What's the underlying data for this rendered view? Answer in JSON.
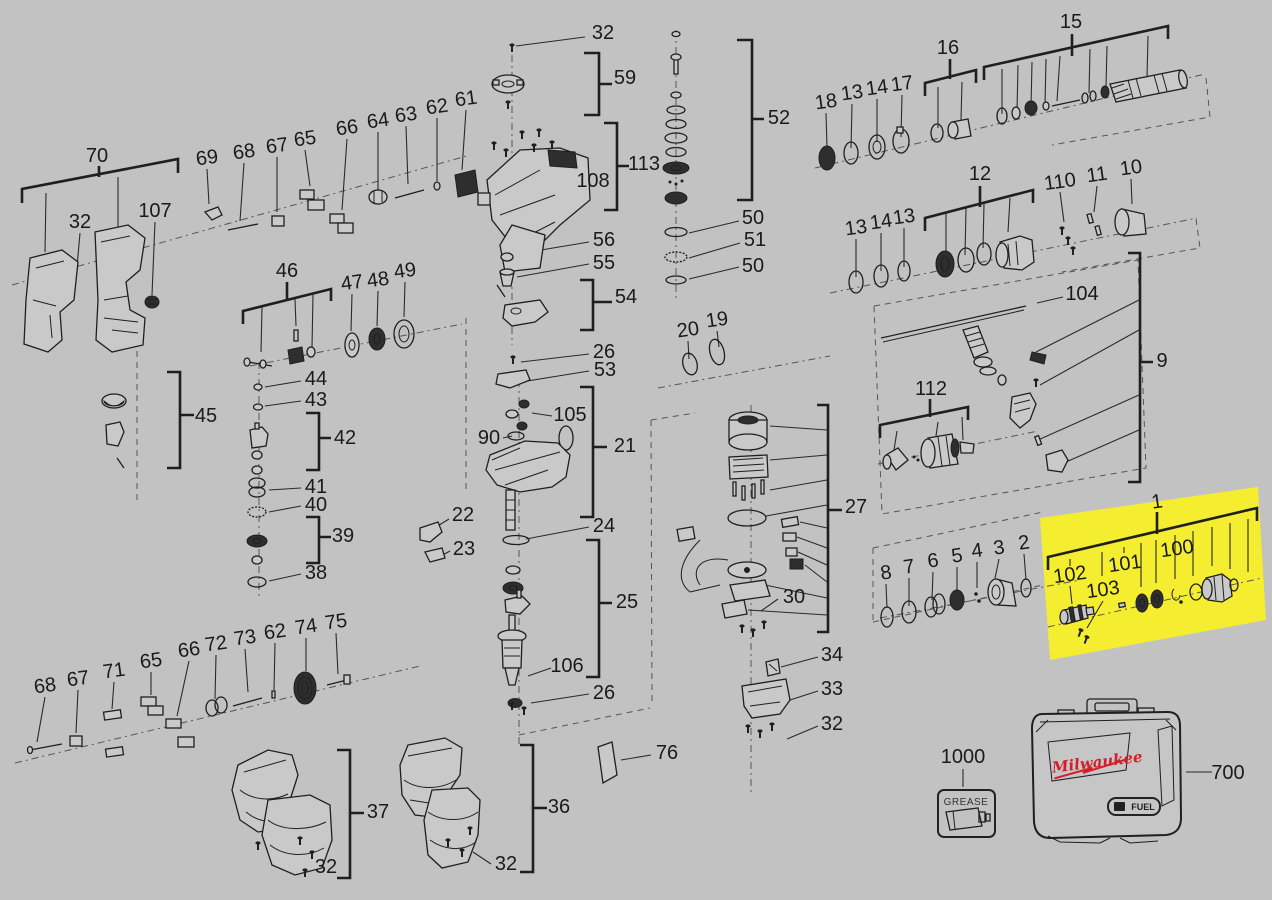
{
  "diagram": {
    "type": "exploded-parts-diagram",
    "background_color": "#c2c2c2",
    "line_color": "#1f1f1f",
    "highlight_color": "#f5ee30",
    "labels": [
      {
        "t": "70",
        "x": 97,
        "y": 156,
        "r": 0
      },
      {
        "t": "32",
        "x": 80,
        "y": 222,
        "r": 0
      },
      {
        "t": "107",
        "x": 155,
        "y": 211,
        "r": 0
      },
      {
        "t": "69",
        "x": 207,
        "y": 158,
        "r": -8
      },
      {
        "t": "68",
        "x": 244,
        "y": 152,
        "r": -8
      },
      {
        "t": "67",
        "x": 277,
        "y": 146,
        "r": -8
      },
      {
        "t": "65",
        "x": 305,
        "y": 139,
        "r": -8
      },
      {
        "t": "66",
        "x": 347,
        "y": 128,
        "r": -8
      },
      {
        "t": "64",
        "x": 378,
        "y": 121,
        "r": -8
      },
      {
        "t": "63",
        "x": 406,
        "y": 115,
        "r": -8
      },
      {
        "t": "62",
        "x": 437,
        "y": 107,
        "r": -8
      },
      {
        "t": "61",
        "x": 466,
        "y": 99,
        "r": -8
      },
      {
        "t": "32",
        "x": 603,
        "y": 33,
        "r": 0
      },
      {
        "t": "59",
        "x": 625,
        "y": 78,
        "r": 0
      },
      {
        "t": "113",
        "x": 644,
        "y": 164,
        "r": 0
      },
      {
        "t": "108",
        "x": 593,
        "y": 181,
        "r": 0
      },
      {
        "t": "56",
        "x": 604,
        "y": 240,
        "r": 0
      },
      {
        "t": "55",
        "x": 604,
        "y": 263,
        "r": 0
      },
      {
        "t": "54",
        "x": 626,
        "y": 297,
        "r": 0
      },
      {
        "t": "26",
        "x": 604,
        "y": 352,
        "r": 0
      },
      {
        "t": "53",
        "x": 605,
        "y": 370,
        "r": 0
      },
      {
        "t": "105",
        "x": 570,
        "y": 415,
        "r": 0
      },
      {
        "t": "90",
        "x": 489,
        "y": 438,
        "r": 0
      },
      {
        "t": "21",
        "x": 625,
        "y": 446,
        "r": 0
      },
      {
        "t": "22",
        "x": 463,
        "y": 515,
        "r": 0
      },
      {
        "t": "23",
        "x": 464,
        "y": 549,
        "r": 0
      },
      {
        "t": "24",
        "x": 604,
        "y": 526,
        "r": 0
      },
      {
        "t": "25",
        "x": 627,
        "y": 602,
        "r": 0
      },
      {
        "t": "106",
        "x": 567,
        "y": 666,
        "r": 0
      },
      {
        "t": "26",
        "x": 604,
        "y": 693,
        "r": 0
      },
      {
        "t": "76",
        "x": 667,
        "y": 753,
        "r": 0
      },
      {
        "t": "36",
        "x": 559,
        "y": 807,
        "r": 0
      },
      {
        "t": "32",
        "x": 506,
        "y": 864,
        "r": 0
      },
      {
        "t": "37",
        "x": 378,
        "y": 812,
        "r": 0
      },
      {
        "t": "32",
        "x": 326,
        "y": 867,
        "r": 0
      },
      {
        "t": "52",
        "x": 779,
        "y": 118,
        "r": 0
      },
      {
        "t": "50",
        "x": 753,
        "y": 218,
        "r": 0
      },
      {
        "t": "51",
        "x": 755,
        "y": 240,
        "r": 0
      },
      {
        "t": "50",
        "x": 753,
        "y": 266,
        "r": 0
      },
      {
        "t": "20",
        "x": 688,
        "y": 330,
        "r": -8
      },
      {
        "t": "19",
        "x": 717,
        "y": 320,
        "r": -8
      },
      {
        "t": "46",
        "x": 287,
        "y": 271,
        "r": 0
      },
      {
        "t": "47",
        "x": 352,
        "y": 283,
        "r": -8
      },
      {
        "t": "48",
        "x": 378,
        "y": 280,
        "r": -8
      },
      {
        "t": "49",
        "x": 405,
        "y": 271,
        "r": -8
      },
      {
        "t": "44",
        "x": 316,
        "y": 379,
        "r": 0
      },
      {
        "t": "43",
        "x": 316,
        "y": 400,
        "r": 0
      },
      {
        "t": "42",
        "x": 345,
        "y": 438,
        "r": 0
      },
      {
        "t": "41",
        "x": 316,
        "y": 487,
        "r": 0
      },
      {
        "t": "40",
        "x": 316,
        "y": 505,
        "r": 0
      },
      {
        "t": "39",
        "x": 343,
        "y": 536,
        "r": 0
      },
      {
        "t": "38",
        "x": 316,
        "y": 573,
        "r": 0
      },
      {
        "t": "45",
        "x": 206,
        "y": 416,
        "r": 0
      },
      {
        "t": "15",
        "x": 1071,
        "y": 22,
        "r": 0
      },
      {
        "t": "16",
        "x": 948,
        "y": 48,
        "r": 0
      },
      {
        "t": "18",
        "x": 826,
        "y": 102,
        "r": -8
      },
      {
        "t": "13",
        "x": 852,
        "y": 93,
        "r": -8
      },
      {
        "t": "14",
        "x": 877,
        "y": 88,
        "r": -8
      },
      {
        "t": "17",
        "x": 902,
        "y": 84,
        "r": -8
      },
      {
        "t": "12",
        "x": 980,
        "y": 174,
        "r": 0
      },
      {
        "t": "13",
        "x": 856,
        "y": 228,
        "r": -8
      },
      {
        "t": "14",
        "x": 881,
        "y": 222,
        "r": -8
      },
      {
        "t": "13",
        "x": 904,
        "y": 217,
        "r": -8
      },
      {
        "t": "110",
        "x": 1060,
        "y": 182,
        "r": -8
      },
      {
        "t": "11",
        "x": 1097,
        "y": 175,
        "r": -8
      },
      {
        "t": "10",
        "x": 1131,
        "y": 168,
        "r": -8
      },
      {
        "t": "104",
        "x": 1082,
        "y": 294,
        "r": 0
      },
      {
        "t": "9",
        "x": 1162,
        "y": 361,
        "r": 0
      },
      {
        "t": "112",
        "x": 931,
        "y": 389,
        "r": 0
      },
      {
        "t": "27",
        "x": 856,
        "y": 507,
        "r": 0
      },
      {
        "t": "30",
        "x": 794,
        "y": 597,
        "r": 0
      },
      {
        "t": "34",
        "x": 832,
        "y": 655,
        "r": 0
      },
      {
        "t": "33",
        "x": 832,
        "y": 689,
        "r": 0
      },
      {
        "t": "32",
        "x": 832,
        "y": 724,
        "r": 0
      },
      {
        "t": "68",
        "x": 45,
        "y": 686,
        "r": -8
      },
      {
        "t": "67",
        "x": 78,
        "y": 679,
        "r": -8
      },
      {
        "t": "71",
        "x": 114,
        "y": 671,
        "r": -8
      },
      {
        "t": "65",
        "x": 151,
        "y": 661,
        "r": -8
      },
      {
        "t": "66",
        "x": 189,
        "y": 650,
        "r": -8
      },
      {
        "t": "72",
        "x": 216,
        "y": 644,
        "r": -8
      },
      {
        "t": "73",
        "x": 245,
        "y": 638,
        "r": -8
      },
      {
        "t": "62",
        "x": 275,
        "y": 632,
        "r": -8
      },
      {
        "t": "74",
        "x": 306,
        "y": 627,
        "r": -8
      },
      {
        "t": "75",
        "x": 336,
        "y": 622,
        "r": -8
      },
      {
        "t": "8",
        "x": 886,
        "y": 573,
        "r": -8
      },
      {
        "t": "7",
        "x": 909,
        "y": 567,
        "r": -8
      },
      {
        "t": "6",
        "x": 933,
        "y": 561,
        "r": -8
      },
      {
        "t": "5",
        "x": 957,
        "y": 556,
        "r": -8
      },
      {
        "t": "4",
        "x": 977,
        "y": 551,
        "r": -8
      },
      {
        "t": "3",
        "x": 999,
        "y": 548,
        "r": -8
      },
      {
        "t": "2",
        "x": 1024,
        "y": 543,
        "r": -8
      },
      {
        "t": "1",
        "x": 1157,
        "y": 502,
        "r": -8
      },
      {
        "t": "100",
        "x": 1177,
        "y": 549,
        "r": -8
      },
      {
        "t": "101",
        "x": 1125,
        "y": 564,
        "r": -8
      },
      {
        "t": "102",
        "x": 1070,
        "y": 575,
        "r": -8
      },
      {
        "t": "103",
        "x": 1103,
        "y": 590,
        "r": -8
      },
      {
        "t": "1000",
        "x": 963,
        "y": 757,
        "r": 0
      },
      {
        "t": "700",
        "x": 1228,
        "y": 773,
        "r": 0
      }
    ]
  },
  "grease_kit": {
    "label": "1000",
    "box_text": "GREASE"
  },
  "carry_case": {
    "label": "700",
    "brand": "Milwaukee",
    "badge": "FUEL",
    "brand_color": "#d31f2b"
  }
}
